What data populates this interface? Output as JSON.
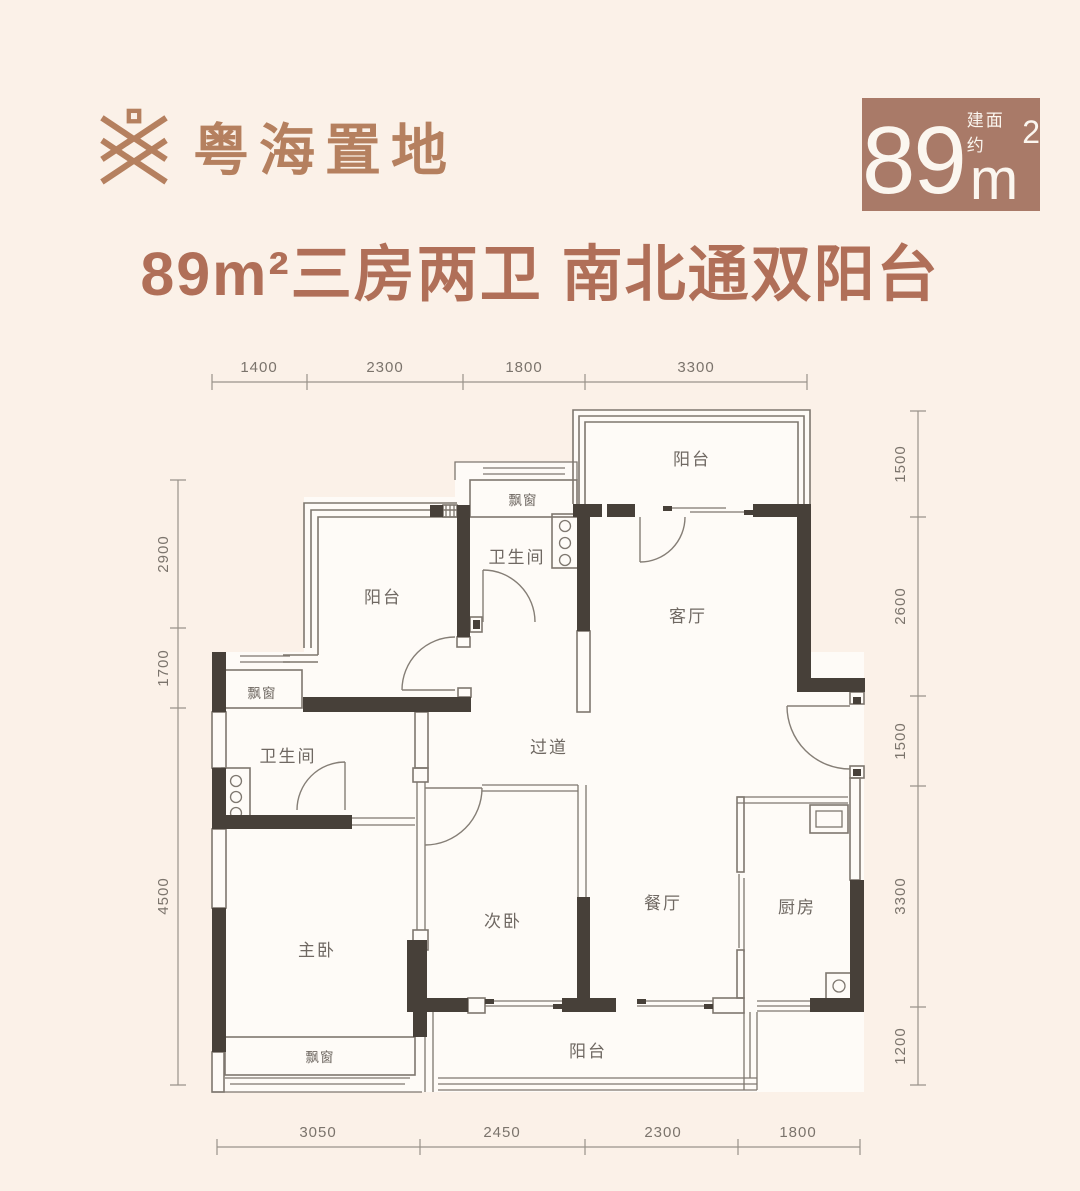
{
  "header": {
    "logo": {
      "text": "粤海置地"
    },
    "area_badge": {
      "number": "89",
      "unit": "m",
      "superscript": "2",
      "note": "建面约"
    },
    "title": "89m²三房两卫 南北通双阳台"
  },
  "plan": {
    "rooms": {
      "balcony_top": "阳台",
      "bay_top": "飘窗",
      "bath_top": "卫生间",
      "living": "客厅",
      "balcony_left": "阳台",
      "bay_left": "飘窗",
      "bath_left": "卫生间",
      "hallway": "过道",
      "bedroom2": "次卧",
      "dining": "餐厅",
      "kitchen": "厨房",
      "master": "主卧",
      "bay_bottom": "飘窗",
      "balcony_bottom": "阳台"
    },
    "dims": {
      "top": [
        "1400",
        "2300",
        "1800",
        "3300"
      ],
      "left": [
        "2900",
        "1700",
        "4500"
      ],
      "right": [
        "1500",
        "2600",
        "1500",
        "3300",
        "1200"
      ],
      "bottom": [
        "3050",
        "2450",
        "2300",
        "1800"
      ]
    }
  },
  "colors": {
    "background": "#fbf1e8",
    "accent_logo": "#b5805f",
    "title": "#b06f58",
    "badge_bg": "#a97a68",
    "wall": "#474039",
    "thin_line": "#7e776f",
    "dim_text": "#7b746c"
  }
}
